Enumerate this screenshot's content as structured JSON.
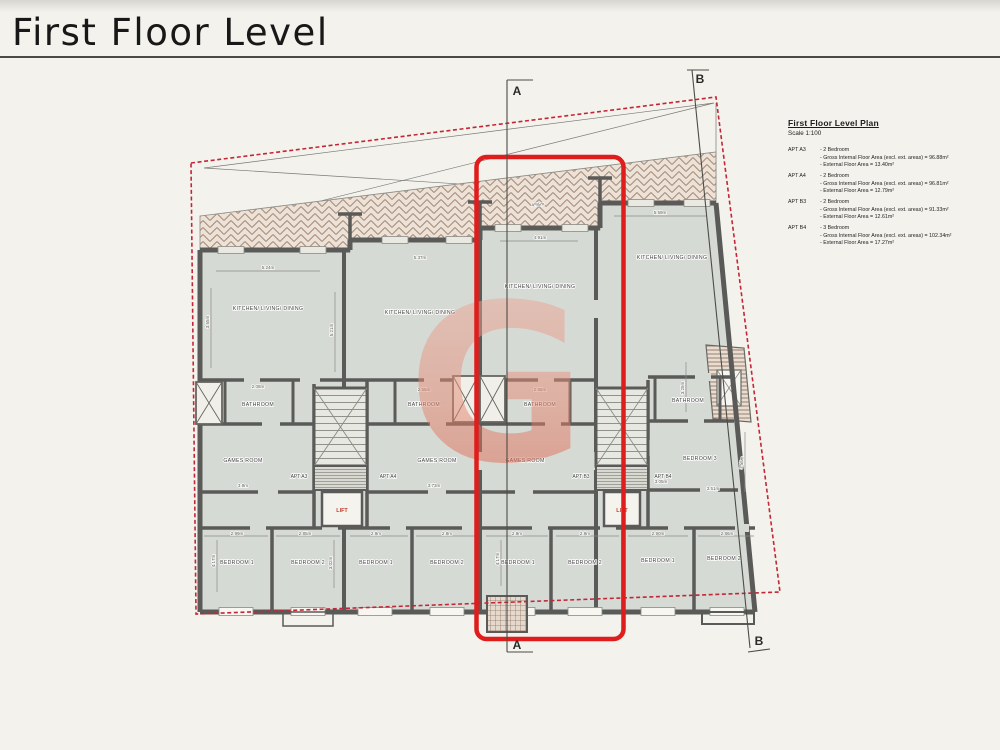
{
  "page": {
    "title": "First Floor Level"
  },
  "legend": {
    "title": "First Floor Level Plan",
    "scale": "Scale 1:100",
    "apartments": [
      {
        "id": "APT A3",
        "bedrooms": "- 2 Bedroom",
        "gifa": "- Gross Internal Floor Area (excl. ext. areas) = 96.88m²",
        "efa": "- External Floor Area = 13.40m²"
      },
      {
        "id": "APT A4",
        "bedrooms": "- 2 Bedroom",
        "gifa": "- Gross Internal Floor Area (excl. ext. areas) = 96.81m²",
        "efa": "- External Floor Area = 12.79m²"
      },
      {
        "id": "APT B3",
        "bedrooms": "- 2 Bedroom",
        "gifa": "- Gross Internal Floor Area (excl. ext. areas) = 91.33m²",
        "efa": "- External Floor Area = 12.61m²"
      },
      {
        "id": "APT B4",
        "bedrooms": "- 3 Bedroom",
        "gifa": "- Gross Internal Floor Area (excl. ext. areas) = 102.34m²",
        "efa": "- External Floor Area = 17.27m²"
      }
    ]
  },
  "plan": {
    "section_a": "A",
    "section_b": "B",
    "lift": "LIFT",
    "apartments": [
      "APT A3",
      "APT A4",
      "APT B3",
      "APT B4"
    ],
    "rooms": {
      "kitchen": "KITCHEN/ LIVING/ DINING",
      "bathroom": "BATHROOM",
      "games": "GAMES ROOM",
      "bedroom1": "BEDROOM 1",
      "bedroom2": "BEDROOM 2",
      "bedroom3": "BEDROOM 3"
    },
    "dims": [
      "5.24m",
      "3.55m",
      "5.21m",
      "5.37m",
      "4.91m",
      "4.95m",
      "5.59m",
      "2.08m",
      "2.55m",
      "2.55m",
      "3.25m",
      "3.9m",
      "3.73m",
      "2.99m",
      "2.85m",
      "2.9m",
      "2.9m",
      "2.9m",
      "2.9m",
      "2.90m",
      "2.86m",
      "4.17m",
      "3.02m",
      "4.17m",
      "3.51m",
      "3.55m",
      "3.05m"
    ]
  },
  "watermark": {
    "letter": "G"
  },
  "colors": {
    "highlight": "#e01d1d",
    "boundary": "#c22737",
    "watermark_top": "#eeb1a2",
    "watermark_bottom": "#d9563f"
  }
}
